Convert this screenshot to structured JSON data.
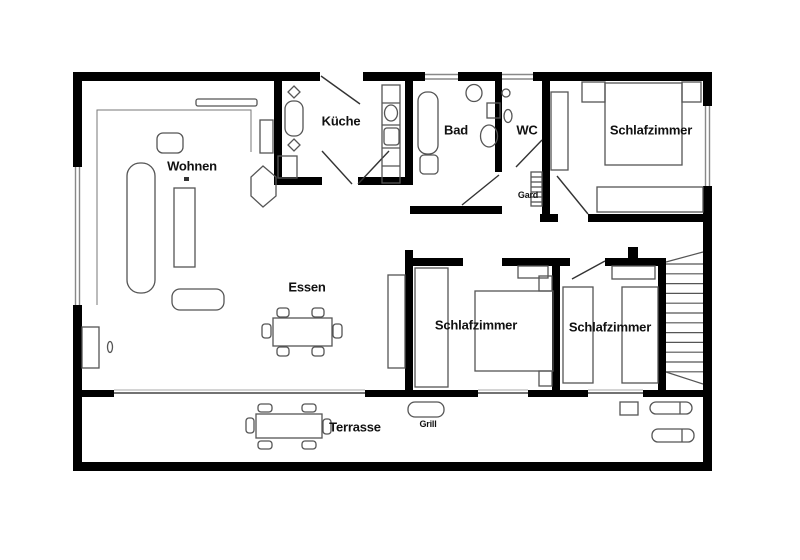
{
  "floor_plan": {
    "rooms": {
      "wohnen": {
        "label": "Wohnen"
      },
      "kueche": {
        "label": "Küche"
      },
      "bad": {
        "label": "Bad"
      },
      "wc": {
        "label": "WC"
      },
      "garderobe": {
        "label": "Gard"
      },
      "schlafzimmer_top": {
        "label": "Schlafzimmer"
      },
      "schlafzimmer_mid": {
        "label": "Schlafzimmer"
      },
      "schlafzimmer_right": {
        "label": "Schlafzimmer"
      },
      "essen": {
        "label": "Essen"
      },
      "terrasse": {
        "label": "Terrasse"
      },
      "grill": {
        "label": "Grill"
      }
    },
    "colors": {
      "wall": "#000000",
      "furniture_outline": "#555555",
      "window_line": "#888888",
      "label_text": "#111111",
      "background": "#ffffff"
    }
  }
}
